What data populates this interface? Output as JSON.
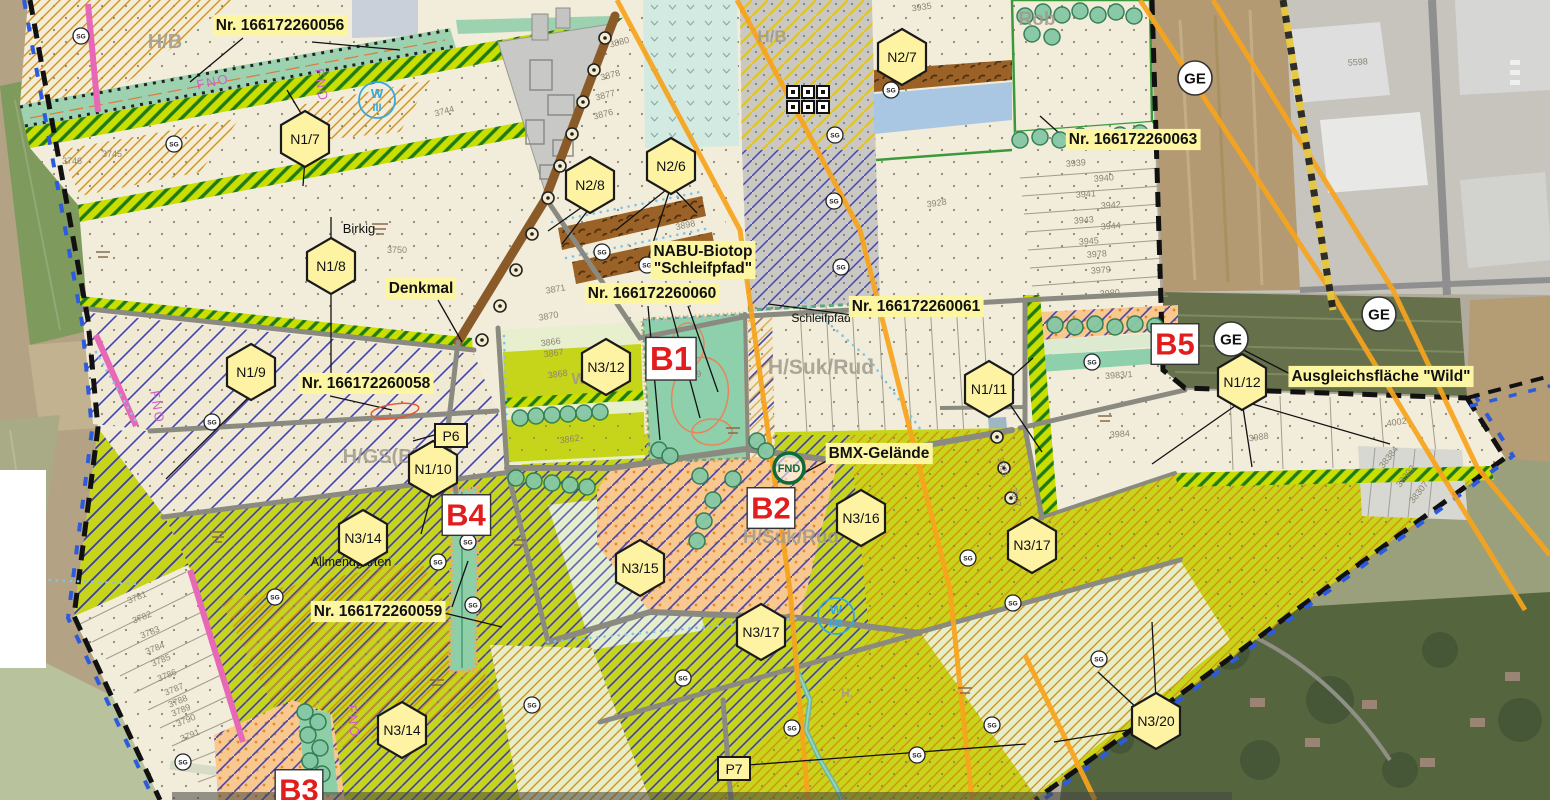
{
  "map": {
    "type": "zoning-plan-overlay-on-aerial",
    "colors": {
      "beige": "#f2edda",
      "chartreuse": "#c6d41a",
      "teal_biotope": "#8ecfac",
      "blue_hatch": "#3f3fae",
      "orange_hatch": "#d89010",
      "power_line_orange": "#f7a41d",
      "label_yellow": "#fcf6a2",
      "hexagon_yellow": "#fdf3a3",
      "red_label": "#e11d1d",
      "boundary_black": "#111111",
      "boundary_blue": "#2c5bdd",
      "boundary_pink": "#e868b8",
      "brown_band": "#9a6227",
      "orange_stipple": "#f8c88e",
      "gray_stipple": "#c9c8c2",
      "tree_green": "#85c8a5",
      "water_blue": "#7ec4e8"
    },
    "annotations": [
      {
        "lines": [
          "Nr. 166172260056"
        ],
        "x": 280,
        "y": 30
      },
      {
        "lines": [
          "Nr. 166172260063"
        ],
        "x": 1133,
        "y": 144
      },
      {
        "lines": [
          "Nr. 166172260060"
        ],
        "x": 652,
        "y": 298
      },
      {
        "lines": [
          "Nr. 166172260061"
        ],
        "x": 916,
        "y": 311
      },
      {
        "lines": [
          "Nr. 166172260058"
        ],
        "x": 366,
        "y": 388
      },
      {
        "lines": [
          "Nr. 166172260059"
        ],
        "x": 378,
        "y": 616
      },
      {
        "lines": [
          "NABU-Biotop",
          "\"Schleifpfad\""
        ],
        "x": 703,
        "y": 256
      },
      {
        "lines": [
          "Ausgleichsfläche \"Wild\""
        ],
        "x": 1381,
        "y": 381
      },
      {
        "lines": [
          "BMX-Gelände"
        ],
        "x": 879,
        "y": 458
      },
      {
        "lines": [
          "Denkmal"
        ],
        "x": 421,
        "y": 293
      }
    ],
    "hexagons": [
      {
        "text": "N1/7",
        "x": 305,
        "y": 139
      },
      {
        "text": "N1/8",
        "x": 331,
        "y": 266
      },
      {
        "text": "N1/9",
        "x": 251,
        "y": 372
      },
      {
        "text": "N1/10",
        "x": 433,
        "y": 469
      },
      {
        "text": "N1/11",
        "x": 989,
        "y": 389
      },
      {
        "text": "N1/12",
        "x": 1242,
        "y": 382
      },
      {
        "text": "N2/6",
        "x": 671,
        "y": 166
      },
      {
        "text": "N2/7",
        "x": 902,
        "y": 57
      },
      {
        "text": "N2/8",
        "x": 590,
        "y": 185
      },
      {
        "text": "N3/12",
        "x": 606,
        "y": 367
      },
      {
        "text": "N3/14",
        "x": 363,
        "y": 538
      },
      {
        "text": "N3/14",
        "x": 402,
        "y": 730
      },
      {
        "text": "N3/15",
        "x": 640,
        "y": 568
      },
      {
        "text": "N3/16",
        "x": 861,
        "y": 518
      },
      {
        "text": "N3/17",
        "x": 761,
        "y": 632
      },
      {
        "text": "N3/17",
        "x": 1032,
        "y": 545
      },
      {
        "text": "N3/20",
        "x": 1156,
        "y": 721
      }
    ],
    "p_labels": [
      {
        "text": "P6",
        "x": 451,
        "y": 436
      },
      {
        "text": "P7",
        "x": 734,
        "y": 769
      }
    ],
    "red_labels": [
      {
        "text": "B1",
        "x": 671,
        "y": 359,
        "size": 33
      },
      {
        "text": "B2",
        "x": 771,
        "y": 508,
        "size": 31
      },
      {
        "text": "B3",
        "x": 299,
        "y": 790,
        "size": 31
      },
      {
        "text": "B4",
        "x": 466,
        "y": 515,
        "size": 31
      },
      {
        "text": "B5",
        "x": 1175,
        "y": 344,
        "size": 31
      }
    ],
    "ge_circles": [
      {
        "text": "GE",
        "x": 1195,
        "y": 78
      },
      {
        "text": "GE",
        "x": 1231,
        "y": 339
      },
      {
        "text": "GE",
        "x": 1379,
        "y": 314
      }
    ],
    "w_circles": [
      {
        "line1": "W",
        "line2": "III",
        "x": 377,
        "y": 100
      },
      {
        "line1": "W",
        "line2": "IIB",
        "x": 836,
        "y": 616
      }
    ],
    "fnd_circle": {
      "text": "FND",
      "x": 789,
      "y": 468
    },
    "place_names": [
      {
        "text": "Birkig",
        "x": 359,
        "y": 233,
        "size": 13
      },
      {
        "text": "Schleifpfad",
        "x": 821,
        "y": 322,
        "size": 12
      },
      {
        "text": "Allmendgarten",
        "x": 351,
        "y": 566,
        "size": 12.5
      }
    ],
    "watermarks": [
      {
        "text": "H/B",
        "x": 165,
        "y": 48,
        "size": 20
      },
      {
        "text": "H/B",
        "x": 772,
        "y": 42,
        "size": 17
      },
      {
        "text": "H/Suk/Rud",
        "x": 821,
        "y": 374,
        "size": 21
      },
      {
        "text": "H/Suk/Rud",
        "x": 791,
        "y": 543,
        "size": 19
      },
      {
        "text": "H/GS(B)",
        "x": 381,
        "y": 463,
        "size": 20
      },
      {
        "text": "Rob",
        "x": 1037,
        "y": 25,
        "size": 19
      },
      {
        "text": "Wr",
        "x": 582,
        "y": 384,
        "size": 16
      },
      {
        "text": "H.",
        "x": 847,
        "y": 697,
        "size": 12
      }
    ],
    "magenta_labels": [
      {
        "text": "FNO",
        "x": 214,
        "y": 86,
        "rot": -12
      },
      {
        "text": "FNO",
        "x": 317,
        "y": 86,
        "rot": 82
      },
      {
        "text": "FNO",
        "x": 153,
        "y": 408,
        "rot": 80
      },
      {
        "text": "FNO",
        "x": 349,
        "y": 722,
        "rot": 84
      }
    ],
    "parcel_numbers": [
      {
        "n": "3744",
        "x": 445,
        "y": 114,
        "r": -15
      },
      {
        "n": "3745",
        "x": 112,
        "y": 157,
        "r": 0
      },
      {
        "n": "3746",
        "x": 72,
        "y": 164,
        "r": 0
      },
      {
        "n": "3750",
        "x": 397,
        "y": 253,
        "r": 0
      },
      {
        "n": "3870",
        "x": 549,
        "y": 319,
        "r": -10
      },
      {
        "n": "3871",
        "x": 556,
        "y": 292,
        "r": -10
      },
      {
        "n": "3866",
        "x": 551,
        "y": 345,
        "r": -8
      },
      {
        "n": "3867",
        "x": 554,
        "y": 356,
        "r": -8
      },
      {
        "n": "3868",
        "x": 558,
        "y": 377,
        "r": -8
      },
      {
        "n": "3862",
        "x": 570,
        "y": 442,
        "r": -8
      },
      {
        "n": "3876",
        "x": 604,
        "y": 117,
        "r": -15
      },
      {
        "n": "3877",
        "x": 606,
        "y": 98,
        "r": -15
      },
      {
        "n": "3878",
        "x": 611,
        "y": 78,
        "r": -15
      },
      {
        "n": "3880",
        "x": 620,
        "y": 45,
        "r": -15
      },
      {
        "n": "3898",
        "x": 686,
        "y": 228,
        "r": -12
      },
      {
        "n": "3935",
        "x": 922,
        "y": 10,
        "r": -8
      },
      {
        "n": "3928",
        "x": 937,
        "y": 206,
        "r": -8
      },
      {
        "n": "3939",
        "x": 1076,
        "y": 166,
        "r": -4
      },
      {
        "n": "3940",
        "x": 1104,
        "y": 181,
        "r": -4
      },
      {
        "n": "3941",
        "x": 1086,
        "y": 197,
        "r": -4
      },
      {
        "n": "3942",
        "x": 1111,
        "y": 208,
        "r": -4
      },
      {
        "n": "3943",
        "x": 1084,
        "y": 223,
        "r": -4
      },
      {
        "n": "3944",
        "x": 1111,
        "y": 229,
        "r": -4
      },
      {
        "n": "3945",
        "x": 1089,
        "y": 244,
        "r": -4
      },
      {
        "n": "3978",
        "x": 1097,
        "y": 257,
        "r": -4
      },
      {
        "n": "3979",
        "x": 1101,
        "y": 273,
        "r": -4
      },
      {
        "n": "3980",
        "x": 1110,
        "y": 296,
        "r": -4
      },
      {
        "n": "3983/1",
        "x": 1119,
        "y": 378,
        "r": -4
      },
      {
        "n": "3984",
        "x": 1120,
        "y": 437,
        "r": -4
      },
      {
        "n": "3988",
        "x": 1259,
        "y": 440,
        "r": -8
      },
      {
        "n": "4002",
        "x": 1397,
        "y": 425,
        "r": -8
      },
      {
        "n": "5598",
        "x": 1358,
        "y": 65,
        "r": -4
      },
      {
        "n": "38384",
        "x": 1391,
        "y": 459,
        "r": -52
      },
      {
        "n": "38302",
        "x": 1408,
        "y": 478,
        "r": -52
      },
      {
        "n": "38307",
        "x": 1421,
        "y": 494,
        "r": -52
      },
      {
        "n": "3781",
        "x": 138,
        "y": 600,
        "r": -22
      },
      {
        "n": "3782",
        "x": 143,
        "y": 620,
        "r": -22
      },
      {
        "n": "3783",
        "x": 151,
        "y": 635,
        "r": -22
      },
      {
        "n": "3784",
        "x": 156,
        "y": 651,
        "r": -22
      },
      {
        "n": "3785",
        "x": 162,
        "y": 663,
        "r": -22
      },
      {
        "n": "3786",
        "x": 168,
        "y": 678,
        "r": -22
      },
      {
        "n": "3787",
        "x": 175,
        "y": 692,
        "r": -22
      },
      {
        "n": "3788",
        "x": 179,
        "y": 704,
        "r": -22
      },
      {
        "n": "3789",
        "x": 182,
        "y": 713,
        "r": -22
      },
      {
        "n": "3790",
        "x": 187,
        "y": 723,
        "r": -22
      },
      {
        "n": "3791",
        "x": 191,
        "y": 738,
        "r": -22
      },
      {
        "n": "3925",
        "x": 1000,
        "y": 468,
        "r": 75
      },
      {
        "n": "3947",
        "x": 1013,
        "y": 498,
        "r": 75
      },
      {
        "n": "3869",
        "x": 692,
        "y": 378,
        "r": -10
      }
    ],
    "sg_symbols": [
      {
        "x": 81,
        "y": 36
      },
      {
        "x": 174,
        "y": 144
      },
      {
        "x": 602,
        "y": 252
      },
      {
        "x": 647,
        "y": 265
      },
      {
        "x": 835,
        "y": 135
      },
      {
        "x": 834,
        "y": 201
      },
      {
        "x": 841,
        "y": 267
      },
      {
        "x": 891,
        "y": 90
      },
      {
        "x": 968,
        "y": 558
      },
      {
        "x": 1013,
        "y": 603
      },
      {
        "x": 212,
        "y": 422
      },
      {
        "x": 275,
        "y": 597
      },
      {
        "x": 438,
        "y": 562
      },
      {
        "x": 468,
        "y": 542
      },
      {
        "x": 473,
        "y": 605
      },
      {
        "x": 683,
        "y": 678
      },
      {
        "x": 792,
        "y": 728
      },
      {
        "x": 917,
        "y": 755
      },
      {
        "x": 992,
        "y": 725
      },
      {
        "x": 1092,
        "y": 362
      },
      {
        "x": 1099,
        "y": 659
      },
      {
        "x": 183,
        "y": 762
      },
      {
        "x": 532,
        "y": 705
      }
    ],
    "tree_point_symbols": [
      {
        "x": 605,
        "y": 38
      },
      {
        "x": 594,
        "y": 70
      },
      {
        "x": 583,
        "y": 102
      },
      {
        "x": 572,
        "y": 134
      },
      {
        "x": 560,
        "y": 166
      },
      {
        "x": 548,
        "y": 198
      },
      {
        "x": 532,
        "y": 234
      },
      {
        "x": 516,
        "y": 270
      },
      {
        "x": 500,
        "y": 306
      },
      {
        "x": 482,
        "y": 340
      },
      {
        "x": 997,
        "y": 437
      },
      {
        "x": 1004,
        "y": 468
      },
      {
        "x": 1011,
        "y": 498
      }
    ],
    "tree_circles": [
      {
        "x": 1025,
        "y": 16
      },
      {
        "x": 1043,
        "y": 12
      },
      {
        "x": 1062,
        "y": 15
      },
      {
        "x": 1080,
        "y": 11
      },
      {
        "x": 1098,
        "y": 15
      },
      {
        "x": 1116,
        "y": 12
      },
      {
        "x": 1134,
        "y": 16
      },
      {
        "x": 1032,
        "y": 34
      },
      {
        "x": 1052,
        "y": 37
      },
      {
        "x": 1020,
        "y": 140
      },
      {
        "x": 1040,
        "y": 137
      },
      {
        "x": 1060,
        "y": 140
      },
      {
        "x": 1080,
        "y": 136
      },
      {
        "x": 1100,
        "y": 139
      },
      {
        "x": 1120,
        "y": 135
      },
      {
        "x": 1140,
        "y": 133
      },
      {
        "x": 520,
        "y": 418
      },
      {
        "x": 536,
        "y": 416
      },
      {
        "x": 552,
        "y": 415
      },
      {
        "x": 568,
        "y": 414
      },
      {
        "x": 584,
        "y": 413
      },
      {
        "x": 600,
        "y": 412
      },
      {
        "x": 700,
        "y": 476
      },
      {
        "x": 733,
        "y": 479
      },
      {
        "x": 713,
        "y": 500
      },
      {
        "x": 704,
        "y": 521
      },
      {
        "x": 697,
        "y": 541
      },
      {
        "x": 659,
        "y": 450
      },
      {
        "x": 670,
        "y": 456
      },
      {
        "x": 757,
        "y": 441
      },
      {
        "x": 766,
        "y": 451
      },
      {
        "x": 516,
        "y": 478
      },
      {
        "x": 534,
        "y": 481
      },
      {
        "x": 552,
        "y": 483
      },
      {
        "x": 570,
        "y": 485
      },
      {
        "x": 587,
        "y": 487
      },
      {
        "x": 305,
        "y": 712
      },
      {
        "x": 318,
        "y": 722
      },
      {
        "x": 308,
        "y": 735
      },
      {
        "x": 320,
        "y": 748
      },
      {
        "x": 310,
        "y": 761
      },
      {
        "x": 322,
        "y": 774
      },
      {
        "x": 312,
        "y": 787
      },
      {
        "x": 1055,
        "y": 325
      },
      {
        "x": 1075,
        "y": 327
      },
      {
        "x": 1095,
        "y": 324
      },
      {
        "x": 1115,
        "y": 327
      },
      {
        "x": 1135,
        "y": 324
      },
      {
        "x": 1155,
        "y": 326
      }
    ],
    "checker_symbol": {
      "x": 808,
      "y": 100
    },
    "red_ellipse": {
      "x": 395,
      "y": 411,
      "rx": 24,
      "ry": 7,
      "rot": -8
    },
    "leader_lines": [
      [
        243,
        38,
        190,
        82
      ],
      [
        312,
        42,
        400,
        50
      ],
      [
        1068,
        141,
        1040,
        116
      ],
      [
        648,
        306,
        660,
        440
      ],
      [
        670,
        306,
        700,
        418
      ],
      [
        688,
        306,
        718,
        392
      ],
      [
        853,
        315,
        768,
        304
      ],
      [
        330,
        396,
        392,
        410
      ],
      [
        440,
        612,
        502,
        627
      ],
      [
        452,
        607,
        468,
        561
      ],
      [
        671,
        186,
        616,
        230
      ],
      [
        671,
        186,
        647,
        262
      ],
      [
        671,
        186,
        697,
        213
      ],
      [
        585,
        205,
        548,
        231
      ],
      [
        592,
        205,
        562,
        244
      ],
      [
        898,
        77,
        886,
        90
      ],
      [
        305,
        120,
        287,
        90
      ],
      [
        305,
        159,
        303,
        186
      ],
      [
        331,
        247,
        331,
        217
      ],
      [
        331,
        286,
        331,
        380
      ],
      [
        251,
        395,
        166,
        479
      ],
      [
        433,
        489,
        421,
        534
      ],
      [
        1007,
        381,
        1033,
        358
      ],
      [
        1005,
        397,
        1042,
        452
      ],
      [
        1242,
        401,
        1152,
        464
      ],
      [
        1242,
        401,
        1252,
        467
      ],
      [
        1242,
        401,
        1390,
        444
      ],
      [
        1156,
        700,
        1152,
        622
      ],
      [
        1139,
        710,
        1098,
        672
      ],
      [
        1140,
        728,
        1054,
        742
      ],
      [
        438,
        434,
        413,
        441
      ],
      [
        748,
        765,
        1026,
        744
      ],
      [
        1300,
        379,
        1228,
        342
      ],
      [
        832,
        458,
        806,
        472
      ],
      [
        438,
        300,
        462,
        342
      ]
    ]
  }
}
